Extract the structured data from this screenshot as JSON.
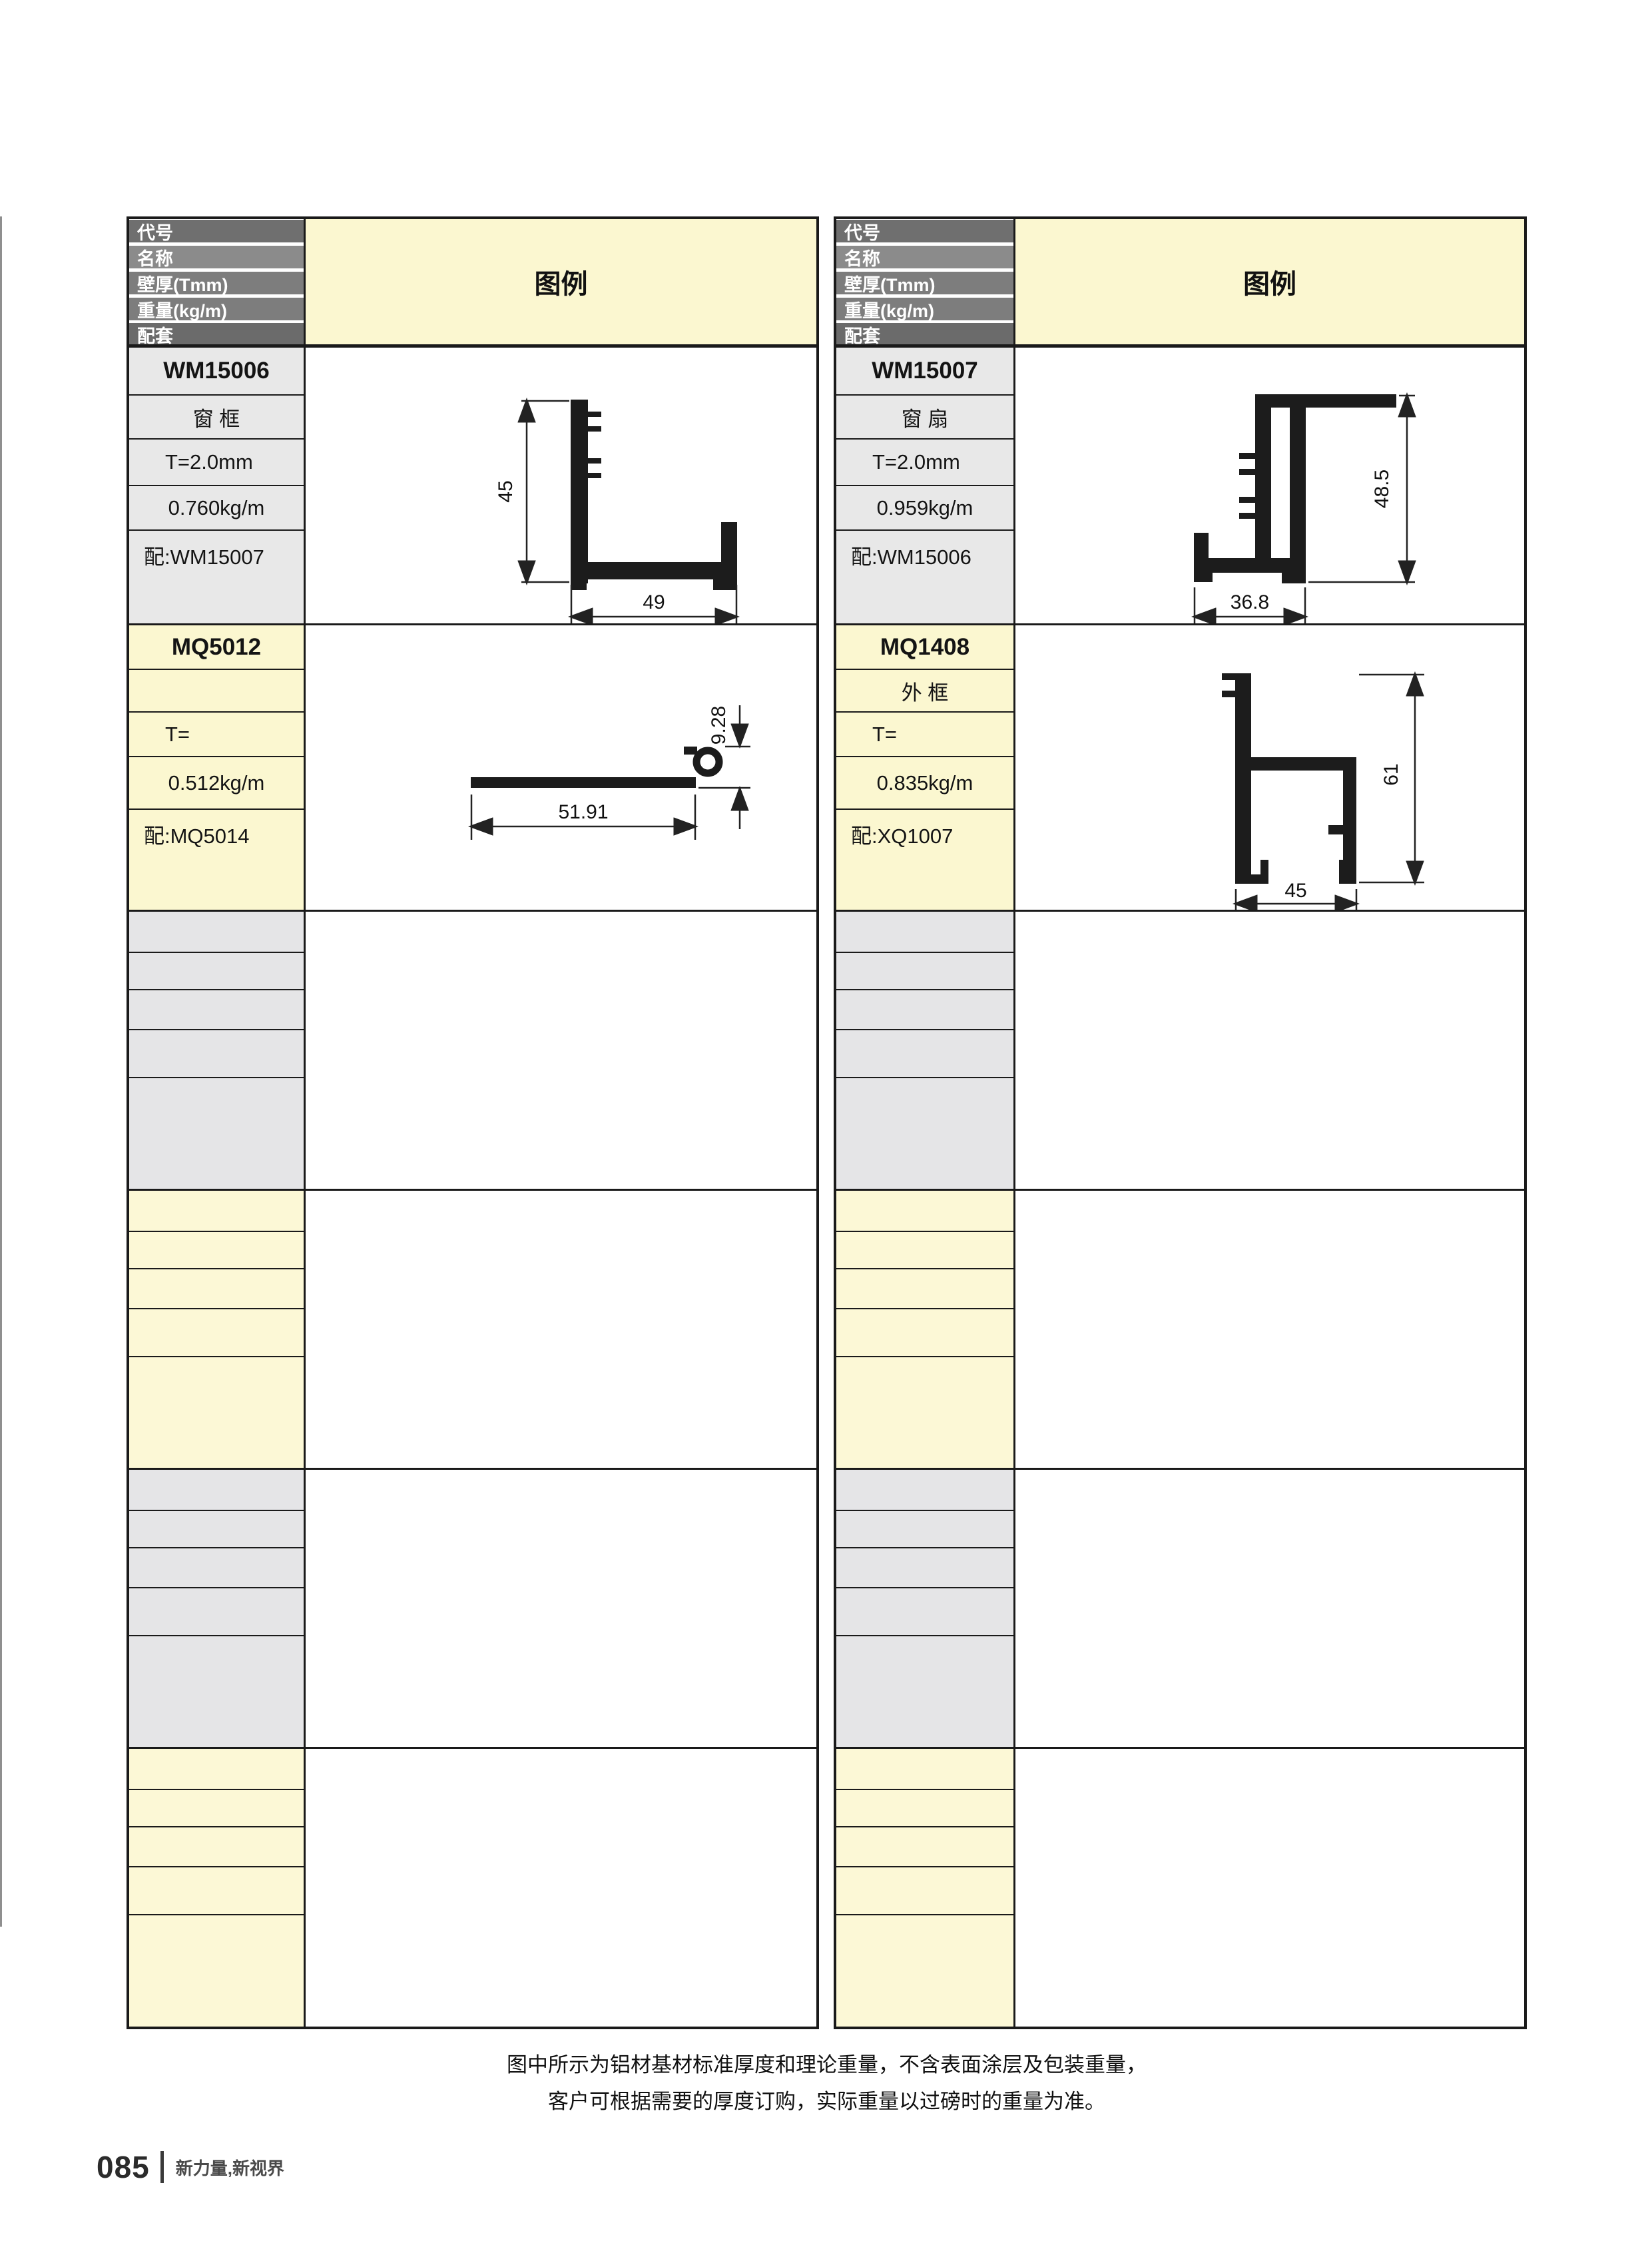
{
  "header_labels": [
    "代号",
    "名称",
    "壁厚(Tmm)",
    "重量(kg/m)",
    "配套"
  ],
  "legend_label": "图例",
  "colors": {
    "header_row_grays": [
      "#6f6f6f",
      "#8b8b8b",
      "#7d7d7d",
      "#7d7d7d",
      "#6b6b6b"
    ],
    "cell_gray": "#e8e8e8",
    "cell_yellow": "#fbf7d0",
    "empty_gray": "#e5e5e7",
    "empty_yellow": "#fcf8d6",
    "border": "#1a1a1a"
  },
  "tables": [
    {
      "side": "left",
      "entries": [
        {
          "code": "WM15006",
          "name": "窗 框",
          "thickness": "T=2.0mm",
          "weight": "0.760kg/m",
          "match": "配:WM15007",
          "diagram": {
            "dim_v": "45",
            "dim_h": "49"
          }
        },
        {
          "code": "MQ5012",
          "name": "",
          "thickness": "T=",
          "weight": "0.512kg/m",
          "match": "配:MQ5014",
          "diagram": {
            "dim_v": "9.28",
            "dim_h": "51.91"
          }
        }
      ]
    },
    {
      "side": "right",
      "entries": [
        {
          "code": "WM15007",
          "name": "窗 扇",
          "thickness": "T=2.0mm",
          "weight": "0.959kg/m",
          "match": "配:WM15006",
          "diagram": {
            "dim_v": "48.5",
            "dim_h": "36.8"
          }
        },
        {
          "code": "MQ1408",
          "name": "外 框",
          "thickness": "T=",
          "weight": "0.835kg/m",
          "match": "配:XQ1007",
          "diagram": {
            "dim_v": "61",
            "dim_h": "45"
          }
        }
      ]
    }
  ],
  "note_line1": "图中所示为铝材基材标准厚度和理论重量，不含表面涂层及包装重量，",
  "note_line2": "客户可根据需要的厚度订购，实际重量以过磅时的重量为准。",
  "footer": {
    "page_number": "085",
    "tagline": "新力量,新视界"
  }
}
